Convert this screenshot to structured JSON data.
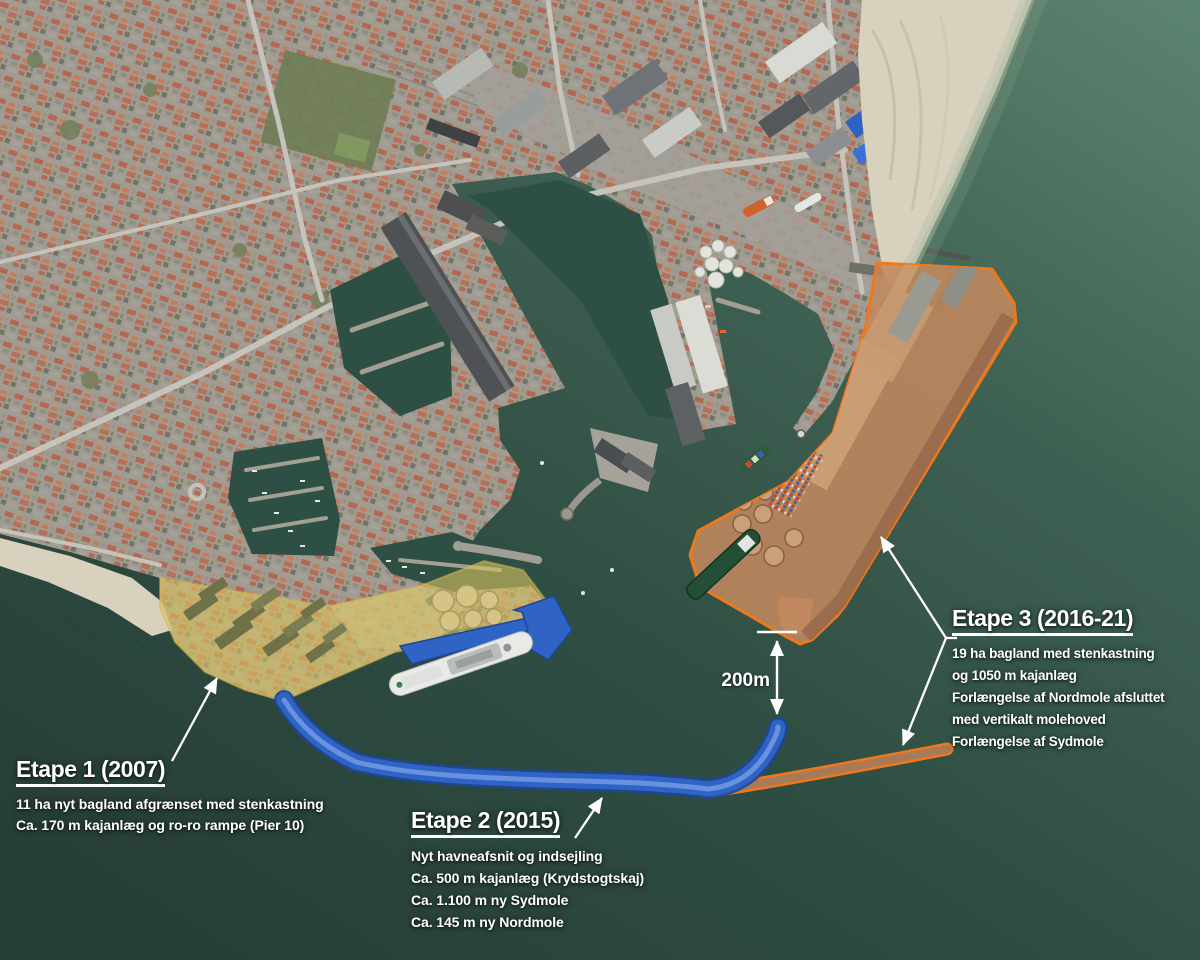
{
  "annotations": {
    "etape1": {
      "title": "Etape 1 (2007)",
      "lines": [
        "11 ha nyt bagland afgrænset med stenkastning",
        "Ca. 170 m kajanlæg og ro-ro rampe (Pier 10)"
      ]
    },
    "etape2": {
      "title": "Etape 2 (2015)",
      "lines": [
        "Nyt havneafsnit og indsejling",
        "Ca. 500 m kajanlæg (Krydstogtskaj)",
        "Ca. 1.100 m ny Sydmole",
        "Ca. 145 m ny Nordmole"
      ]
    },
    "etape3": {
      "title": "Etape 3 (2016-21)",
      "lines": [
        "19 ha bagland med stenkastning",
        "og 1050 m kajanlæg",
        "Forlængelse af Nordmole afsluttet",
        "med vertikalt molehoved",
        "Forlængelse af Sydmole"
      ]
    },
    "measurement": {
      "label": "200m"
    }
  },
  "colors": {
    "etape1_fill": "#d8c35f",
    "etape2_fill": "#2f63c6",
    "etape3_fill": "#c0895f",
    "etape3_outline": "#ee791c",
    "sydmole_fill": "#a87a56",
    "label_text": "#ffffff"
  }
}
